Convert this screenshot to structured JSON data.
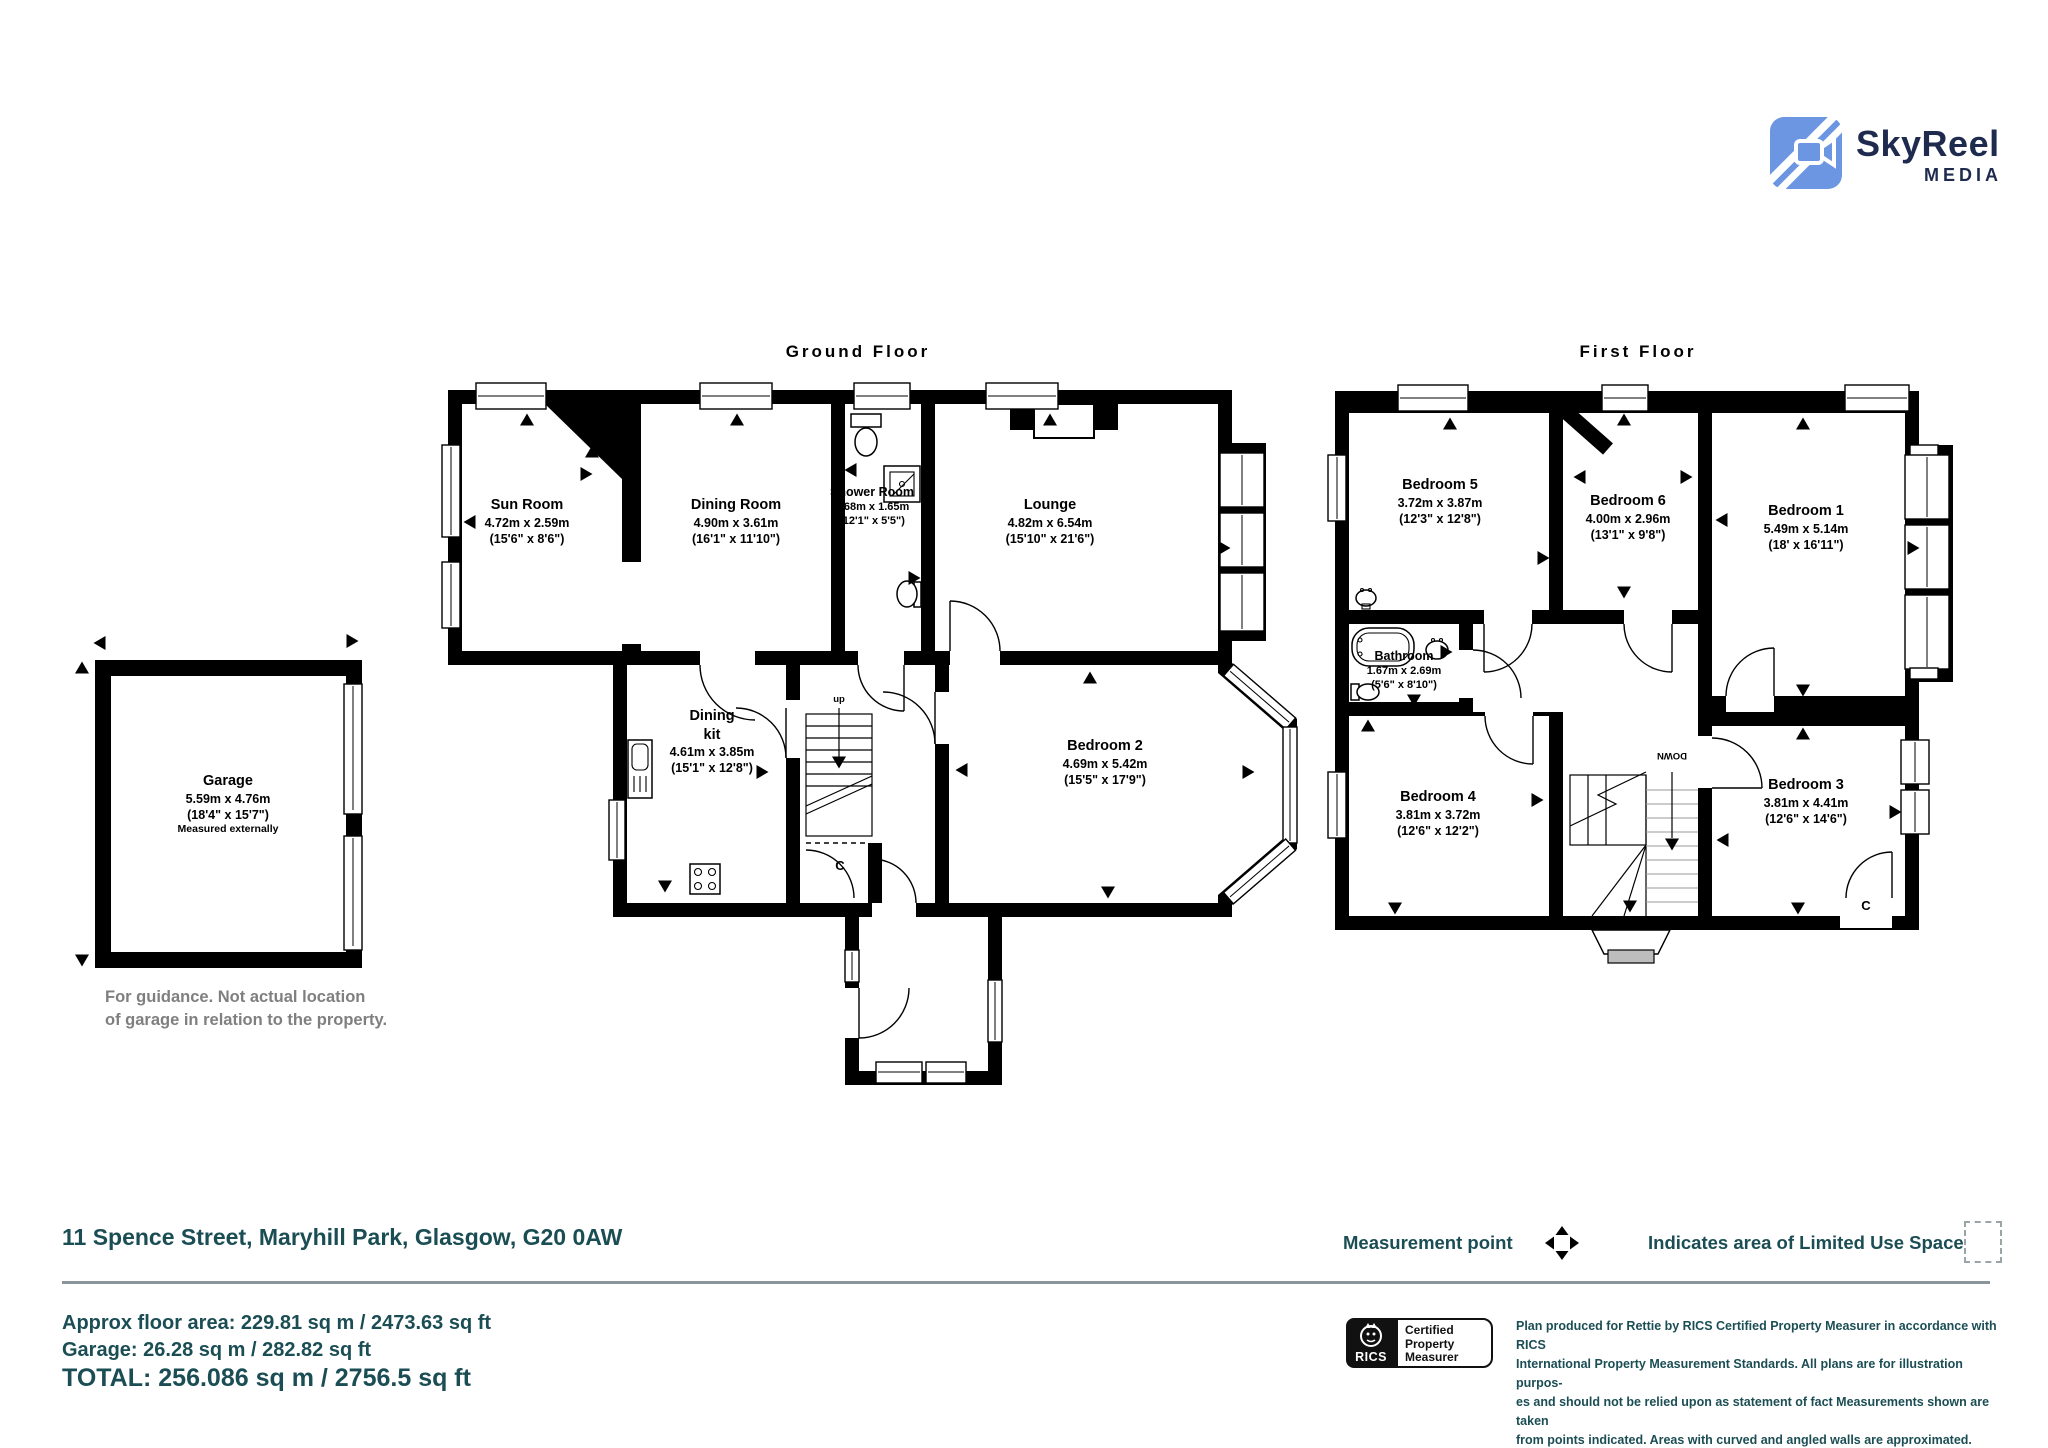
{
  "logo": {
    "brand": "SkyReel",
    "sub": "MEDIA"
  },
  "ground": {
    "title": "Ground Floor",
    "stairs_label": "up",
    "closet_label": "C",
    "rooms": [
      {
        "name": "Sun Room",
        "metric": "4.72m x 2.59m",
        "imperial": "(15'6\" x 8'6\")"
      },
      {
        "name": "Dining Room",
        "metric": "4.90m x 3.61m",
        "imperial": "(16'1\" x 11'10\")"
      },
      {
        "name": "Shower Room",
        "metric": "3.68m x 1.65m",
        "imperial": "(12'1\" x 5'5\")"
      },
      {
        "name": "Lounge",
        "metric": "4.82m x 6.54m",
        "imperial": "(15'10\" x 21'6\")"
      },
      {
        "name": "Dining",
        "name2": "kit",
        "metric": "4.61m x 3.85m",
        "imperial": "(15'1\" x 12'8\")"
      },
      {
        "name": "Bedroom 2",
        "metric": "4.69m x 5.42m",
        "imperial": "(15'5\" x 17'9\")"
      }
    ]
  },
  "first": {
    "title": "First Floor",
    "stairs_label": "DOWN",
    "closet_label": "C",
    "rooms": [
      {
        "name": "Bedroom 5",
        "metric": "3.72m x 3.87m",
        "imperial": "(12'3\" x 12'8\")"
      },
      {
        "name": "Bedroom 6",
        "metric": "4.00m x 2.96m",
        "imperial": "(13'1\" x 9'8\")"
      },
      {
        "name": "Bedroom 1",
        "metric": "5.49m x 5.14m",
        "imperial": "(18' x 16'11\")"
      },
      {
        "name": "Bathroom",
        "metric": "1.67m x 2.69m",
        "imperial": "(5'6\" x 8'10\")"
      },
      {
        "name": "Bedroom 4",
        "metric": "3.81m x 3.72m",
        "imperial": "(12'6\" x 12'2\")"
      },
      {
        "name": "Bedroom 3",
        "metric": "3.81m x 4.41m",
        "imperial": "(12'6\" x 14'6\")"
      }
    ]
  },
  "garage": {
    "name": "Garage",
    "metric": "5.59m x 4.76m",
    "imperial": "(18'4\" x 15'7\")",
    "note": "Measured externally",
    "guidance1": "For guidance. Not actual location",
    "guidance2": "of garage in relation to the property."
  },
  "footer": {
    "address": "11 Spence Street, Maryhill Park, Glasgow, G20 0AW",
    "area_line1": "Approx floor area: 229.81 sq m / 2473.63 sq ft",
    "area_line2": "Garage: 26.28 sq m / 282.82 sq ft",
    "total": "TOTAL: 256.086 sq m / 2756.5 sq ft",
    "legend_measurement": "Measurement point",
    "legend_limited": "Indicates area of  Limited Use Space",
    "rics_brand": "RICS",
    "rics_line1": "Certified",
    "rics_line2": "Property",
    "rics_line3": "Measurer",
    "disclaimer_line1": "Plan produced for Rettie by RICS Certified Property Measurer in accordance with RICS",
    "disclaimer_line2": "International Property  Measurement Standards.  All plans are for illustration purpos-",
    "disclaimer_line3": "es and should not be relied upon as statement of fact Measurements shown are taken",
    "disclaimer_line4": "from points indicated. Areas with curved and angled walls are approximated.",
    "colors": {
      "teal": "#1b4e54",
      "guidance_gray": "#7f7f7f",
      "logo_blue": "#6c96e2",
      "logo_navy": "#1e2b4e"
    }
  }
}
